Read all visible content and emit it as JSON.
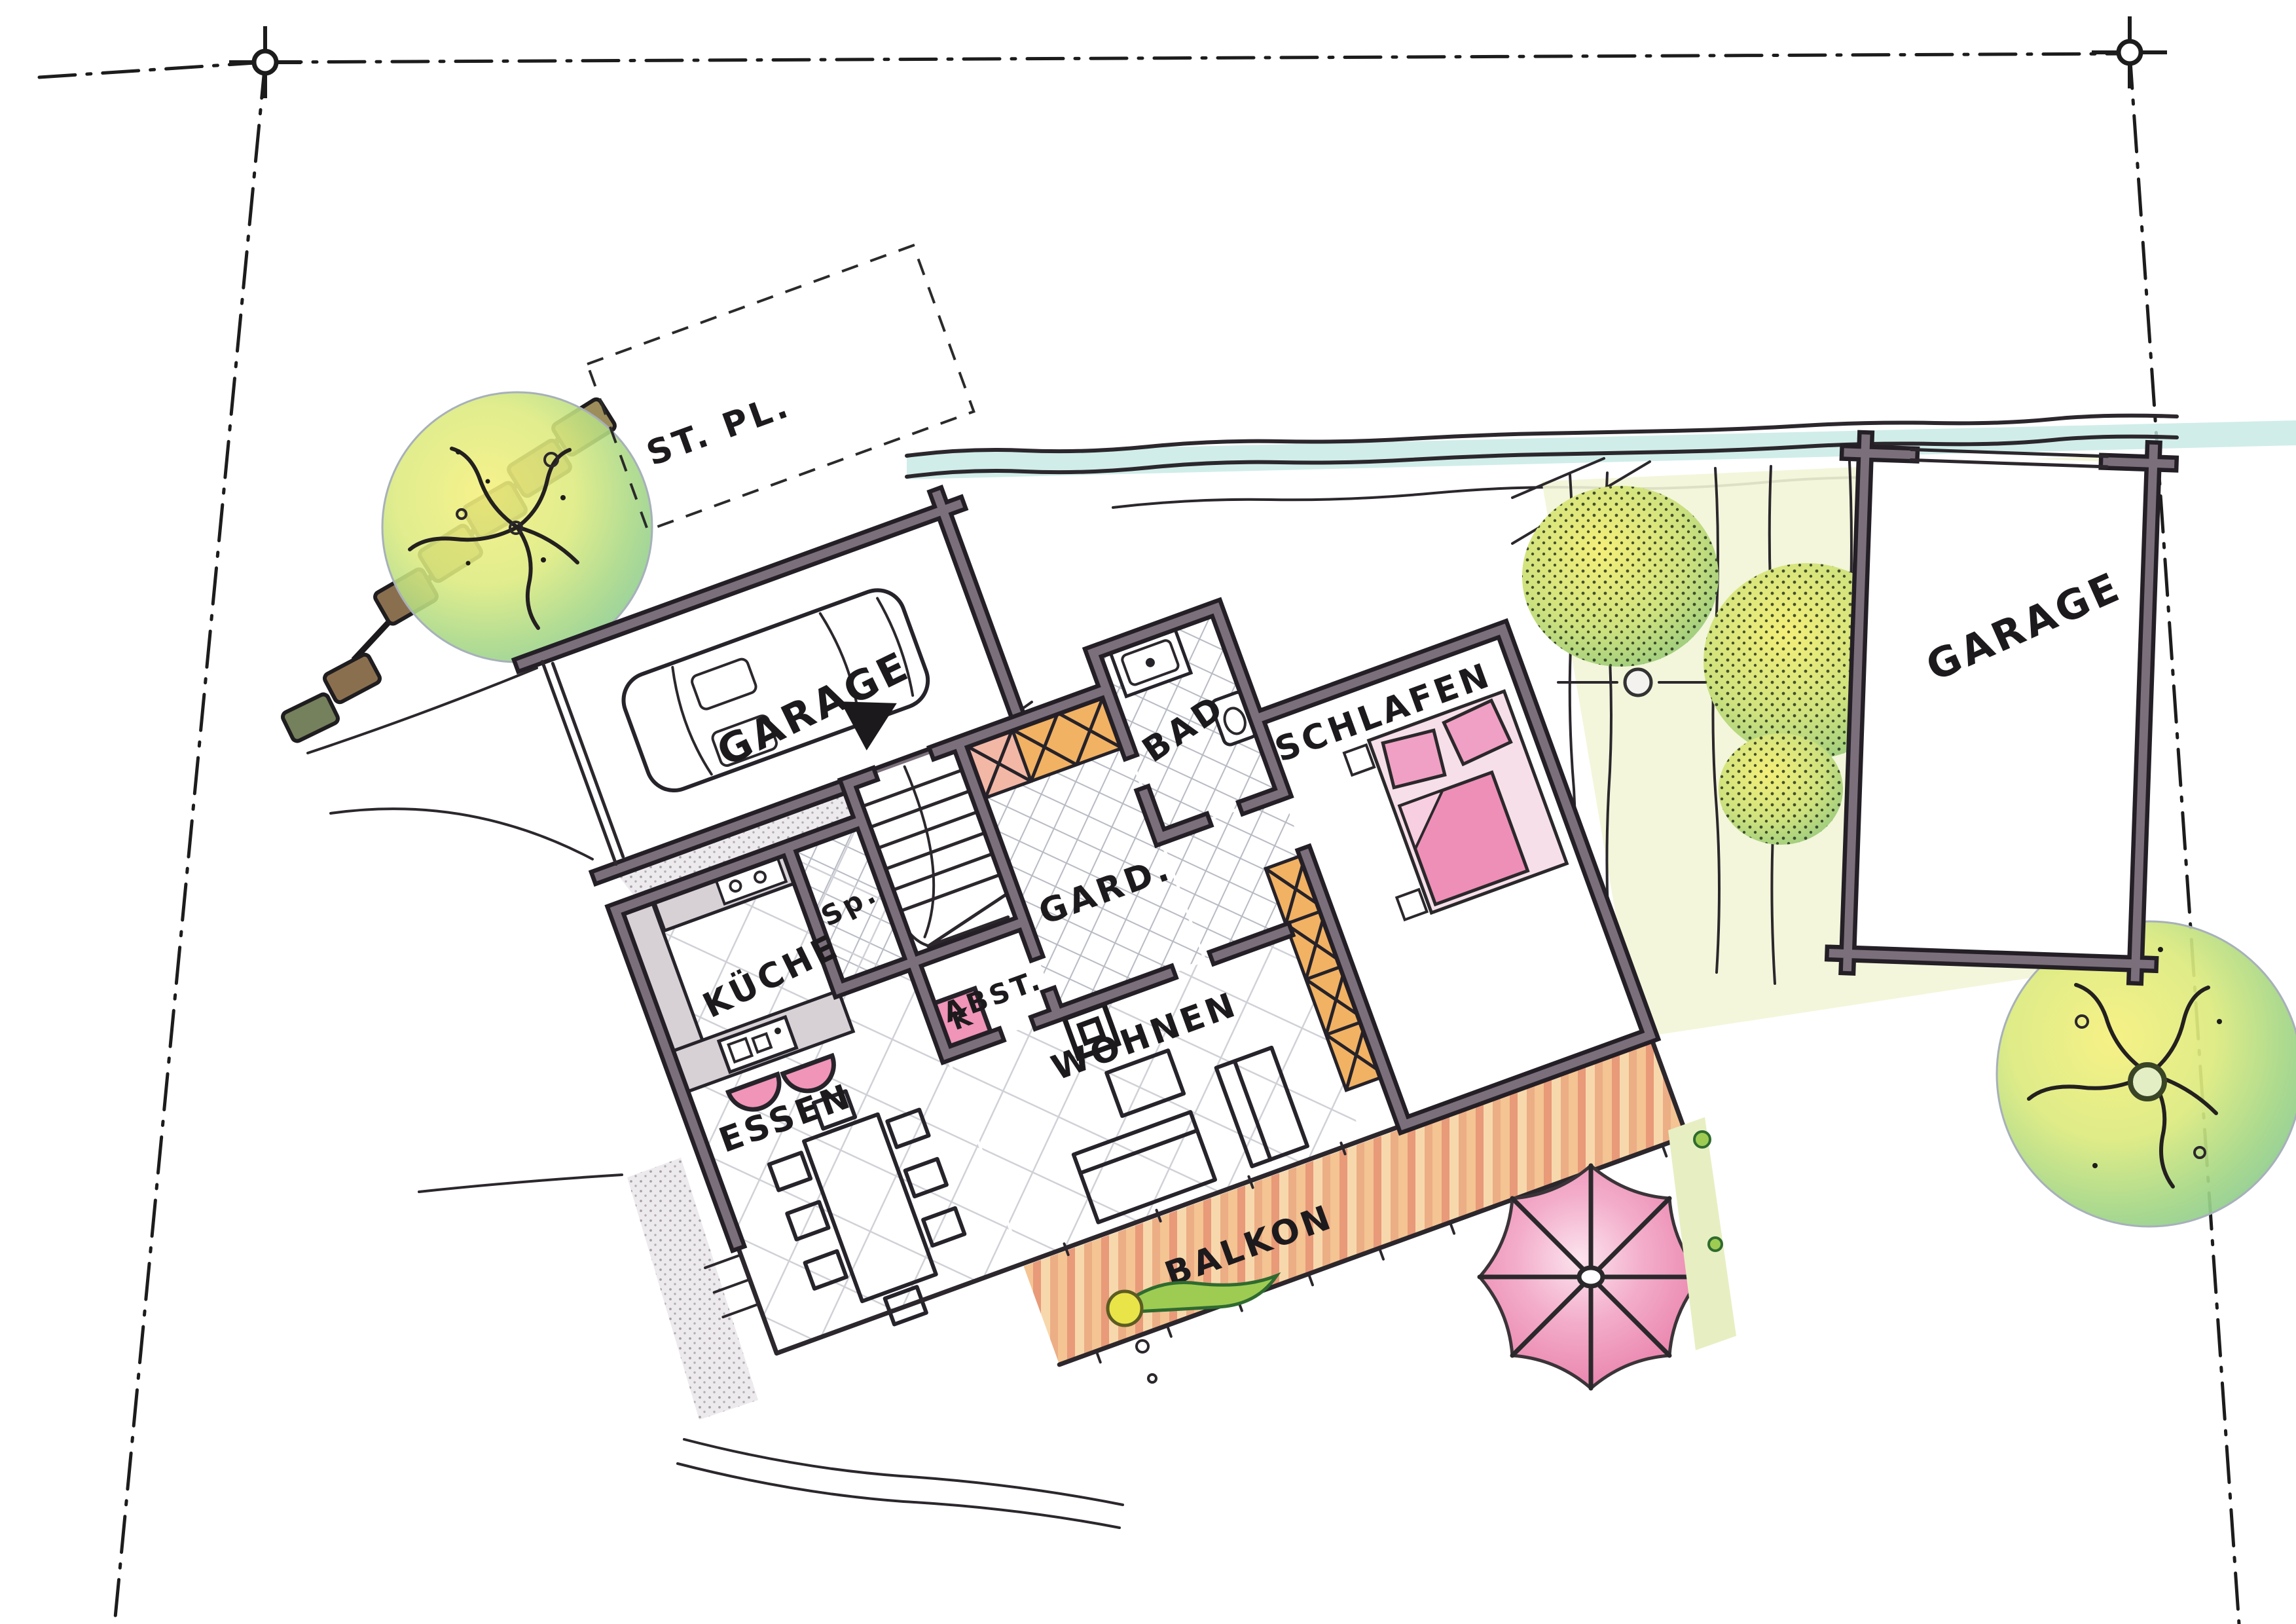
{
  "plan": {
    "labels": {
      "parking": "ST. PL.",
      "garage_left": "GARAGE",
      "garage_right": "GARAGE",
      "cloakroom": "GARD.",
      "bathroom": "BAD",
      "bedroom": "SCHLAFEN",
      "storage": "ABST.",
      "pantry": "Sp.",
      "kitchen": "KÜCHE",
      "living_room": "WOHNEN",
      "stove": "K",
      "dining": "ESSEN",
      "balcony": "BALKON"
    },
    "colors": {
      "paper": "#ffffff",
      "wall_ink": "#241f26",
      "wall_gray": "#7a6f7a",
      "closet_orange": "#f2b263",
      "bed_pink": "#ee8fb8",
      "umbrella_pink": "#e87ca8",
      "tree_yellow": "#f5f07c",
      "tree_green": "#82c793",
      "stream_teal": "#c4e8e3",
      "deck_terracotta": "#eda47e",
      "tile_line": "#b6b9c2"
    }
  }
}
